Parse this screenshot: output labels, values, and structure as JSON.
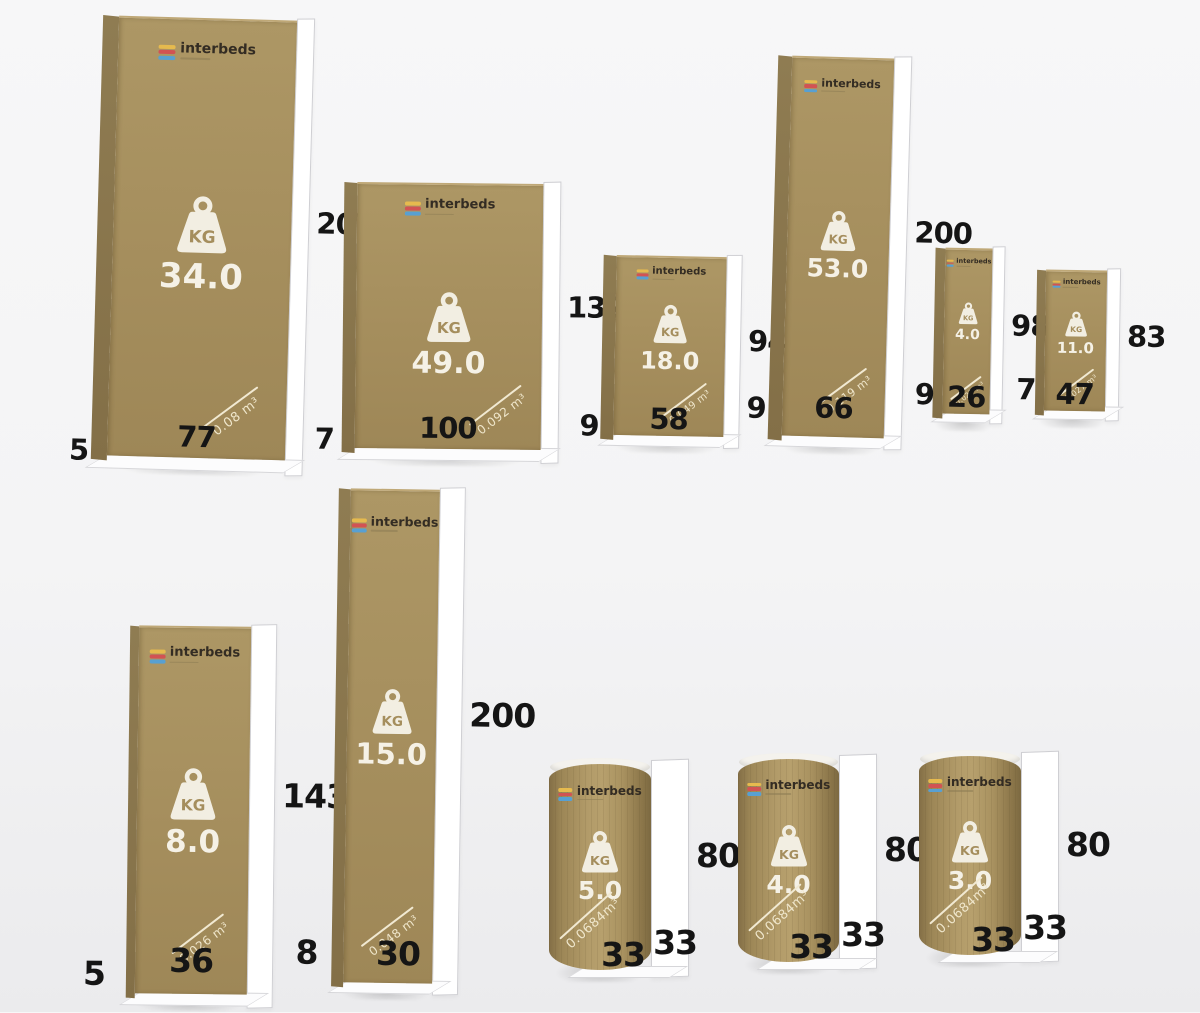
{
  "brand": {
    "name": "interbeds"
  },
  "labels": {
    "kg": "KG"
  },
  "items": [
    {
      "shape": "box",
      "weight_kg": "34.0",
      "height": "207",
      "width": "77",
      "depth": "5",
      "volume": "0.08 m³"
    },
    {
      "shape": "box",
      "weight_kg": "49.0",
      "height": "132",
      "width": "100",
      "depth": "7",
      "volume": "0.092 m³"
    },
    {
      "shape": "box",
      "weight_kg": "18.0",
      "height": "94",
      "width": "58",
      "depth": "9",
      "volume": "0.049 m³"
    },
    {
      "shape": "box",
      "weight_kg": "53.0",
      "height": "200",
      "width": "66",
      "depth": "9",
      "volume": "0.119 m³"
    },
    {
      "shape": "box",
      "weight_kg": "4.0",
      "height": "98",
      "width": "26",
      "depth": "9",
      "volume": "0.023 m³"
    },
    {
      "shape": "box",
      "weight_kg": "11.0",
      "height": "83",
      "width": "47",
      "depth": "7",
      "volume": "0.027 m³"
    },
    {
      "shape": "box",
      "weight_kg": "8.0",
      "height": "143",
      "width": "36",
      "depth": "5",
      "volume": "0.026 m³"
    },
    {
      "shape": "box",
      "weight_kg": "15.0",
      "height": "200",
      "width": "30",
      "depth": "8",
      "volume": "0.048 m³"
    },
    {
      "shape": "cylinder",
      "weight_kg": "5.0",
      "height": "80",
      "diameter_front": "33",
      "diameter_side": "33",
      "volume": "0.0684m³"
    },
    {
      "shape": "cylinder",
      "weight_kg": "4.0",
      "height": "80",
      "diameter_front": "33",
      "diameter_side": "33",
      "volume": "0.0684m³"
    },
    {
      "shape": "cylinder",
      "weight_kg": "3.0",
      "height": "80",
      "diameter_front": "33",
      "diameter_side": "33",
      "volume": "0.0684m³"
    }
  ]
}
